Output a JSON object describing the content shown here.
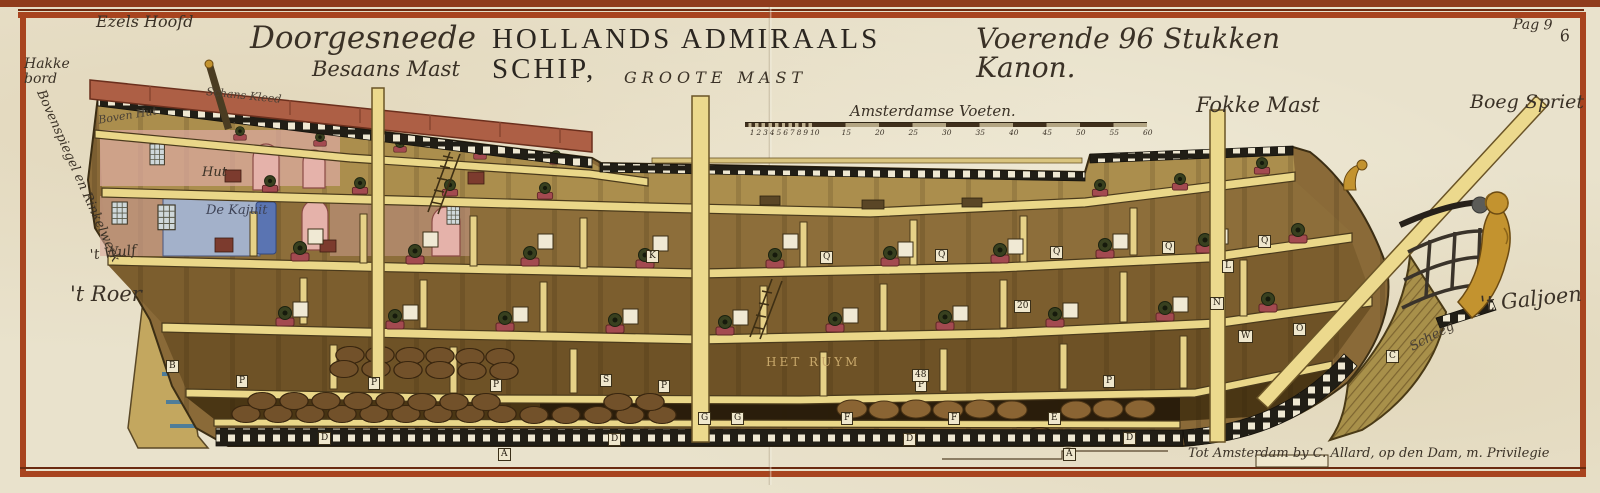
{
  "plate": {
    "page_mark": "Pag 9",
    "plate_number": "6",
    "imprint": "Tot Amsterdam by C. Allard, op den Dam, m. Privilegie"
  },
  "title": {
    "script_lead": "Doorgesneede",
    "roman": "HOLLANDS ADMIRAALS SCHIP,",
    "script_tail": "Voerende 96 Stukken Kanon."
  },
  "labels": {
    "ezels_hoofd": "Ezels Hoofd",
    "hakkebord": "Hakke\nbord",
    "bovenspiegel": "Bovenspiegel en Rinkelwerk",
    "boven_hut": "Boven Hut",
    "schans_kleed": "Schans Kleed",
    "hut": "Hut",
    "de_kajuit": "De Kajuit",
    "t_wulf": "'t Wulf",
    "t_roer": "'t Roer",
    "besaans_mast": "Besaans Mast",
    "groote_mast": "GROOTE MAST",
    "fokke_mast": "Fokke Mast",
    "boeg_spriet": "Boeg Spriet",
    "t_galjoen": "'t Galjoen",
    "scheeg": "Scheeg",
    "het_ruym": "HET RUYM"
  },
  "scale_bar": {
    "title": "Amsterdamse Voeten.",
    "minor_ticks": [
      "1",
      "2",
      "3",
      "4",
      "5",
      "6",
      "7",
      "8",
      "9",
      "10"
    ],
    "major_ticks": [
      "15",
      "20",
      "25",
      "30",
      "35",
      "40",
      "45",
      "50",
      "55",
      "60"
    ]
  },
  "reference_letters": [
    {
      "t": "Q",
      "x": 820,
      "y": 251
    },
    {
      "t": "Q",
      "x": 935,
      "y": 249
    },
    {
      "t": "Q",
      "x": 1050,
      "y": 246
    },
    {
      "t": "Q",
      "x": 1162,
      "y": 241
    },
    {
      "t": "Q",
      "x": 1258,
      "y": 235
    },
    {
      "t": "K",
      "x": 646,
      "y": 250
    },
    {
      "t": "L",
      "x": 1222,
      "y": 260
    },
    {
      "t": "N",
      "x": 1210,
      "y": 297
    },
    {
      "t": "O",
      "x": 1293,
      "y": 323
    },
    {
      "t": "W",
      "x": 1238,
      "y": 330
    },
    {
      "t": "P",
      "x": 236,
      "y": 375
    },
    {
      "t": "P",
      "x": 368,
      "y": 377
    },
    {
      "t": "P",
      "x": 490,
      "y": 379
    },
    {
      "t": "P",
      "x": 658,
      "y": 380
    },
    {
      "t": "P",
      "x": 915,
      "y": 379
    },
    {
      "t": "P",
      "x": 1103,
      "y": 375
    },
    {
      "t": "S",
      "x": 600,
      "y": 374
    },
    {
      "t": "B",
      "x": 166,
      "y": 360
    },
    {
      "t": "C",
      "x": 1386,
      "y": 350
    },
    {
      "t": "G",
      "x": 698,
      "y": 412
    },
    {
      "t": "G",
      "x": 731,
      "y": 412
    },
    {
      "t": "F",
      "x": 841,
      "y": 412
    },
    {
      "t": "F",
      "x": 948,
      "y": 412
    },
    {
      "t": "E",
      "x": 1048,
      "y": 412
    },
    {
      "t": "D",
      "x": 318,
      "y": 432
    },
    {
      "t": "D",
      "x": 608,
      "y": 433
    },
    {
      "t": "D",
      "x": 903,
      "y": 433
    },
    {
      "t": "D",
      "x": 1123,
      "y": 432
    },
    {
      "t": "A",
      "x": 498,
      "y": 448
    },
    {
      "t": "A",
      "x": 1063,
      "y": 448
    },
    {
      "t": "20",
      "x": 1014,
      "y": 300
    },
    {
      "t": "48",
      "x": 912,
      "y": 369
    }
  ],
  "colors": {
    "paper": "#e9e2cc",
    "frame_red": "#a8441f",
    "hull_wood": "#8d6e3a",
    "deck": "#ead789",
    "awning": "#ad5f45",
    "gold": "#c3932f"
  }
}
